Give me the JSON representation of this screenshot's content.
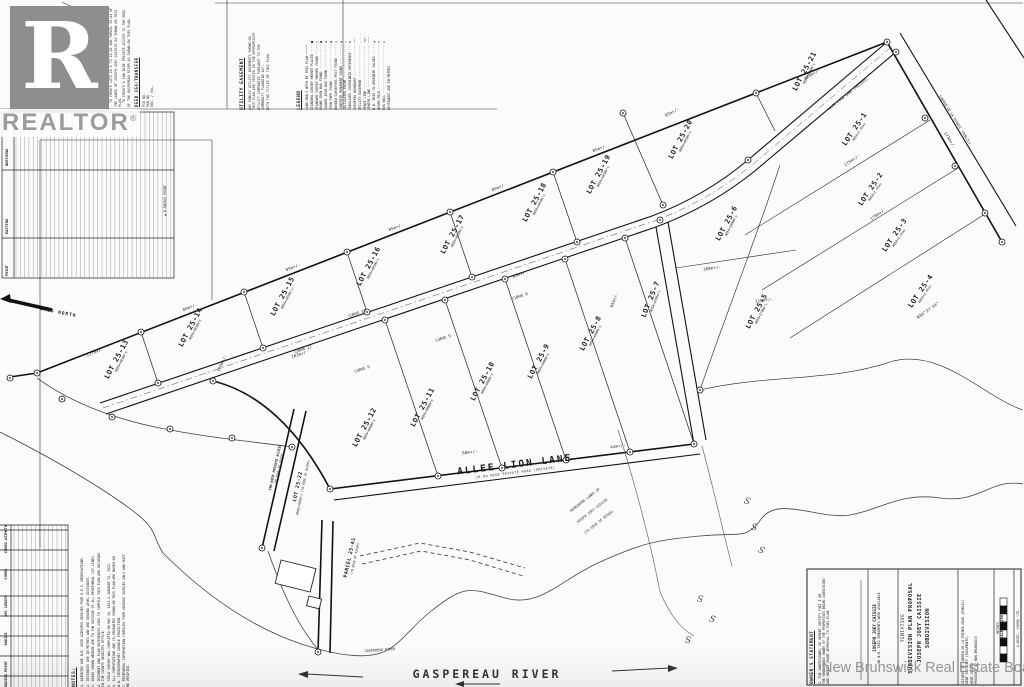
{
  "branding": {
    "logo_letter": "R",
    "logo_word": "REALTOR",
    "registered": "®",
    "watermark": "New Brunswick Real Estate Board"
  },
  "north_arrow": {
    "label": "GRID NORTH"
  },
  "point_table": {
    "headers": [
      "POINT",
      "EASTING",
      "NORTHING"
    ],
    "note": "▲ A RADIUS POINT"
  },
  "purpose": {
    "heading": "PURPOSE OF PLAN",
    "lines": [
      "- TO CREATE LOTS 25-1 TO 25-22 AND PARCEL 25-A1 OF THE LANDS OF JOSEPH JOEY CAISSIE AS SHOWN ON THIS PLAN.",
      "- TO CREATE A 10m WIDE PRIVATE ACCESS TO THE EDGE OF THE GASPEREAU RIVER AS SHOWN ON THIS PLAN."
    ],
    "deed_heading": "DEED 354/TRANSFER",
    "deed_lines": [
      "PID NO.",
      "PAN NO.",
      "DOC. / VOL."
    ]
  },
  "utility": {
    "heading": "UTILITY EASEMENT",
    "lines": [
      "ANY PUBLIC UTILITY EASEMENTS SHOWN ON THIS PLAN ARE VESTED IN THE APPROPRIATE UTILITY COMPANIES PURSUANT TO THE COMMUNITY PLANNING ACT.",
      "WITH THE TITLES OF THIS PLAN."
    ]
  },
  "legend": {
    "heading": "LEGEND",
    "items": [
      "LAND DEALT WITH BY THIS PLAN ─────",
      "STANDARD SURVEY MARKER PLACED ···· ■",
      "STANDARD SURVEY MARKER FOUND ····· □",
      "ROUND IRON BAR FOUND ············· ●",
      "SQUARE IRON BAR FOUND ············ ▪",
      "IRON PIPE FOUND ·················· ◉",
      "WOODEN SURVEYORS POST FOUND ······ ○",
      "CONCRETE MONUMENT FOUND ·········· ◆",
      "CALCULATED POINT ················· △",
      "TABULATED COORDINATE REFERENCE ··· ⊕",
      "SURVEYED BOUNDARY ················ ──",
      "UTILITY EASEMENT ················· - - -",
      "FENCE LINE ······················· ─x─",
      "CENTRE LINE ······················ ─·─",
      "N.B. GRID CO-ORDINATE VALUES ····· ▲",
      "HYDRO POLE ······················· ⊙",
      "DUG WELL ························· ◎",
      "DISTANCES ARE IN METRES"
    ]
  },
  "notes": {
    "heading": "NOTES:",
    "items": [
      "1. AZIMUTHS ARE N.B. GRID AZIMUTHS DERIVED FROM G.P.S. OBSERVATIONS.",
      "2. DISTANCES ARE IN METRES AND ARE GROUND LEVEL DISTANCES.",
      "3. AREAS SHOWN HEREON ARE TO THE OUTSIDE OF ALL PERIPHERAL LOT LINES.",
      "4. DOCUMENT AND PLAN REFERENCES USED TO COMPILE THIS PLAN ARE RECORDED IN THE COUNTY REGISTRY OFFICE.",
      "5. FIELD SURVEY WAS COMPLETED ON MAY 16, 2021 & JANUARY 12, 2022.",
      "6. ALL COMPUTATIONS AND CO-ORDINATES SHOWN ON THIS PLAN ARE BASED ON N.B. STEREOGRAPHIC DOUBLE PROJECTION.",
      "7. PERIPHERAL INFORMATION COMPILED FROM VARIOUS SOURCES ONLY AND MUST BE VERIFIED."
    ]
  },
  "curve_table": {
    "headers": [
      "RADIUS POINT",
      "RADIUS",
      "ARC LENGTH",
      "CHORD",
      "CHORD AZIMUTH"
    ]
  },
  "roads": {
    "allee_lion_lane": "ALLEE LION LANE",
    "allee_sub": "10.0m WIDE PRIVATE ROAD (PRIVATE)",
    "access_label": "10m WIDE PRIVATE ACCESS",
    "access_sub": "(TO EDGE OF RIVER)"
  },
  "river": {
    "name": "GASPEREAU RIVER",
    "small": "GASPEREAU RIVER"
  },
  "parcel_a1": {
    "name": "PARCEL 25-A1",
    "sub": "(TO EDGE OF RIVER)"
  },
  "lot22": {
    "name": "LOT 25-22",
    "sub": "AREA=4300m²± (TO EDGE OF RIVER)"
  },
  "lots": [
    {
      "name": "LOT 25-1",
      "area": "AREA=1.4ha±",
      "x": 856,
      "y": 130,
      "rot": -56
    },
    {
      "name": "LOT 25-2",
      "area": "AREA=1.4ha±",
      "x": 872,
      "y": 190,
      "rot": -56
    },
    {
      "name": "LOT 25-3",
      "area": "AREA=1.4ha±",
      "x": 896,
      "y": 236,
      "rot": -56
    },
    {
      "name": "LOT 25-4",
      "area": "AREA=1.5ha±",
      "x": 922,
      "y": 292,
      "rot": -56
    },
    {
      "name": "LOT 25-5",
      "area": "AREA=5700m²±",
      "x": 758,
      "y": 312,
      "rot": -62
    },
    {
      "name": "LOT 25-6",
      "area": "AREA=5000m²±",
      "x": 728,
      "y": 224,
      "rot": -62
    },
    {
      "name": "LOT 25-7",
      "area": "AREA=4000m²±",
      "x": 652,
      "y": 300,
      "rot": -68
    },
    {
      "name": "LOT 25-8",
      "area": "AREA=4000m²±",
      "x": 592,
      "y": 334,
      "rot": -62
    },
    {
      "name": "LOT 25-9",
      "area": "AREA=4000m²±",
      "x": 540,
      "y": 362,
      "rot": -62
    },
    {
      "name": "LOT 25-10",
      "area": "AREA=4000m²±",
      "x": 484,
      "y": 382,
      "rot": -62
    },
    {
      "name": "LOT 25-11",
      "area": "AREA=4000m²±",
      "x": 424,
      "y": 408,
      "rot": -62
    },
    {
      "name": "LOT 25-12",
      "area": "AREA=4000m²±",
      "x": 366,
      "y": 428,
      "rot": -62
    },
    {
      "name": "LOT 25-13",
      "area": "AREA=4050m²±",
      "x": 118,
      "y": 360,
      "rot": -62
    },
    {
      "name": "LOT 25-14",
      "area": "AREA=4050m²±",
      "x": 192,
      "y": 328,
      "rot": -62
    },
    {
      "name": "LOT 25-15",
      "area": "AREA=4050m²±",
      "x": 284,
      "y": 297,
      "rot": -62
    },
    {
      "name": "LOT 25-16",
      "area": "AREA=4050m²±",
      "x": 370,
      "y": 267,
      "rot": -62
    },
    {
      "name": "LOT 25-17",
      "area": "AREA=4050m²±",
      "x": 454,
      "y": 235,
      "rot": -62
    },
    {
      "name": "LOT 25-18",
      "area": "AREA=4050m²±",
      "x": 536,
      "y": 203,
      "rot": -62
    },
    {
      "name": "LOT 25-19",
      "area": "AREA=4050m²±",
      "x": 600,
      "y": 175,
      "rot": -62
    },
    {
      "name": "LOT 25-20",
      "area": "AREA=4050m²±",
      "x": 682,
      "y": 140,
      "rot": -62
    },
    {
      "name": "LOT 25-21",
      "area": "AREA=5200m²±",
      "x": 806,
      "y": 72,
      "rot": -62
    }
  ],
  "annotations": [
    {
      "text": "127m+/-",
      "x": 95,
      "y": 352,
      "rot": -21,
      "cls": "m"
    },
    {
      "text": "85m+/-",
      "x": 190,
      "y": 307,
      "rot": -21,
      "cls": "m"
    },
    {
      "text": "85m+/-",
      "x": 293,
      "y": 267,
      "rot": -21,
      "cls": "m"
    },
    {
      "text": "85m+/-",
      "x": 396,
      "y": 227,
      "rot": -21,
      "cls": "m"
    },
    {
      "text": "85m+/-",
      "x": 499,
      "y": 187,
      "rot": -21,
      "cls": "m"
    },
    {
      "text": "85m+/-",
      "x": 600,
      "y": 148,
      "rot": -21,
      "cls": "m"
    },
    {
      "text": "85m+/-",
      "x": 672,
      "y": 112,
      "rot": -27,
      "cls": "m"
    },
    {
      "text": "103m+/-",
      "x": 812,
      "y": 74,
      "rot": -31,
      "cls": "m"
    },
    {
      "text": "103m+/-",
      "x": 300,
      "y": 354,
      "rot": -19,
      "cls": "m"
    },
    {
      "text": "85m+/-",
      "x": 520,
      "y": 274,
      "rot": -19,
      "cls": "m"
    },
    {
      "text": "100m+/-",
      "x": 222,
      "y": 363,
      "rot": -65,
      "cls": "m"
    },
    {
      "text": "95m+/-",
      "x": 614,
      "y": 300,
      "rot": -70,
      "cls": "m"
    },
    {
      "text": "175m+/-",
      "x": 852,
      "y": 160,
      "rot": -35,
      "cls": "m"
    },
    {
      "text": "178m+/-",
      "x": 878,
      "y": 214,
      "rot": -35,
      "cls": "m"
    },
    {
      "text": "173m+/-",
      "x": 950,
      "y": 140,
      "rot": 58,
      "cls": "m"
    },
    {
      "text": "108m+/-",
      "x": 712,
      "y": 268,
      "rot": -8,
      "cls": "m"
    },
    {
      "text": "118m+/-",
      "x": 764,
      "y": 300,
      "rot": -8,
      "cls": "m"
    },
    {
      "text": "N36°37'44\"",
      "x": 928,
      "y": 310,
      "rot": -35,
      "cls": "m"
    },
    {
      "text": "60m+/-",
      "x": 470,
      "y": 452,
      "rot": -7,
      "cls": "m"
    },
    {
      "text": "44m+/-",
      "x": 618,
      "y": 446,
      "rot": -7,
      "cls": "m"
    },
    {
      "text": "CURVE 17",
      "x": 303,
      "y": 349,
      "rot": -19,
      "cls": "curve"
    },
    {
      "text": "CURVE 14",
      "x": 357,
      "y": 313,
      "rot": -19,
      "cls": "curve"
    },
    {
      "text": "CURVE 9",
      "x": 443,
      "y": 338,
      "rot": -19,
      "cls": "curve"
    },
    {
      "text": "CURVE 6",
      "x": 362,
      "y": 369,
      "rot": -19,
      "cls": "curve"
    },
    {
      "text": "CURVE 8",
      "x": 520,
      "y": 296,
      "rot": -19,
      "cls": "curve"
    },
    {
      "text": "ALLEE LION LANE (PRIVATE)",
      "x": 848,
      "y": 94,
      "rot": -38,
      "cls": "m3"
    },
    {
      "text": "CHEMIN DE LA POINTE (PUBLIC)",
      "x": 955,
      "y": 120,
      "rot": 58,
      "cls": "m3"
    },
    {
      "text": "REMAINING LANDS OF",
      "x": 585,
      "y": 500,
      "rot": -38,
      "cls": "m3"
    },
    {
      "text": "JOSEPH JOEY CAISSIE",
      "x": 592,
      "y": 511,
      "rot": -38,
      "cls": "m3"
    },
    {
      "text": "(TO EDGE OF RIVER)",
      "x": 599,
      "y": 522,
      "rot": -38,
      "cls": "m3"
    },
    {
      "text": "GASPEREAU RIVER",
      "x": 380,
      "y": 650,
      "rot": -4,
      "cls": "m3"
    },
    {
      "text": "S",
      "x": 747,
      "y": 502,
      "rot": 20,
      "cls": "sq"
    },
    {
      "text": "S",
      "x": 754,
      "y": 528,
      "rot": 12,
      "cls": "sq"
    },
    {
      "text": "S",
      "x": 761,
      "y": 551,
      "rot": 24,
      "cls": "sq"
    },
    {
      "text": "S",
      "x": 700,
      "y": 600,
      "rot": 10,
      "cls": "sq"
    },
    {
      "text": "S",
      "x": 712,
      "y": 620,
      "rot": 18,
      "cls": "sq"
    },
    {
      "text": "S",
      "x": 688,
      "y": 641,
      "rot": 8,
      "cls": "sq"
    }
  ],
  "title_block": {
    "owners_heading": "OWNER'S STATEMENT",
    "owners_lines": [
      "I, THE UNDERSIGNED, DO HEREBY CERTIFY THAT I AM",
      "THE REGISTERED OWNER OF THE PROPERTIES BEING SUBDIVIDED",
      "AND HEREBY GRANT APPROVAL TO THIS PLAN."
    ],
    "signature_name": "JOSEPH JOEY CAISSIE",
    "name_note": "NO N.B. GRID MONUMENTS WERE AVAILABLE",
    "title_lines": [
      "TENTATIVE",
      "SUBDIVISION PLAN PROPOSAL",
      "JOSEPH JOEY CAISSIE",
      "SUBDIVISION"
    ],
    "location_lines": [
      "SITUATE OF CHEMIN DE LA POINTE ROAD (PUBLIC)",
      "KENT DISTRICT (DOCUMENTS)",
      "KENT COUNTY",
      "PROVINCE OF NEW BRUNSWICK"
    ],
    "metres_label": "METRES",
    "scale_label": "SCALE 1:1250",
    "firm_line": "& ASSOC. (1998) LTD."
  }
}
